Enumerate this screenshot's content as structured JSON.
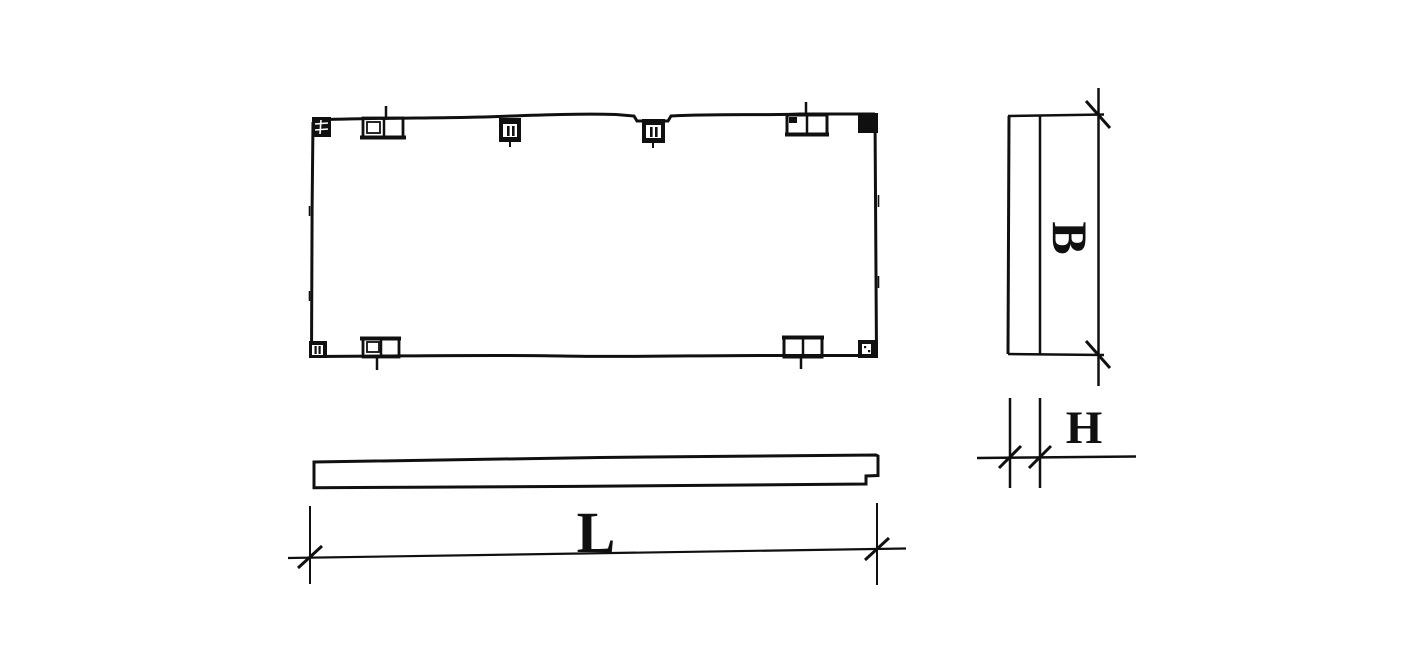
{
  "drawing": {
    "description": "Black-and-white engineering drawing of a precast rectangular slab panel: plan view with embedded lifting inserts at corners and edges, thin side elevation below with end rebate, end view at right, and dimension callouts",
    "colors": {
      "ink": "#101010",
      "background": "#ffffff"
    },
    "views": {
      "plan": {
        "name": "plan-view"
      },
      "elevation": {
        "name": "side-elevation"
      },
      "end": {
        "name": "end-view"
      }
    },
    "dimensions": {
      "length": {
        "label": "L"
      },
      "width": {
        "label": "B"
      },
      "thickness": {
        "label": "H"
      }
    }
  }
}
